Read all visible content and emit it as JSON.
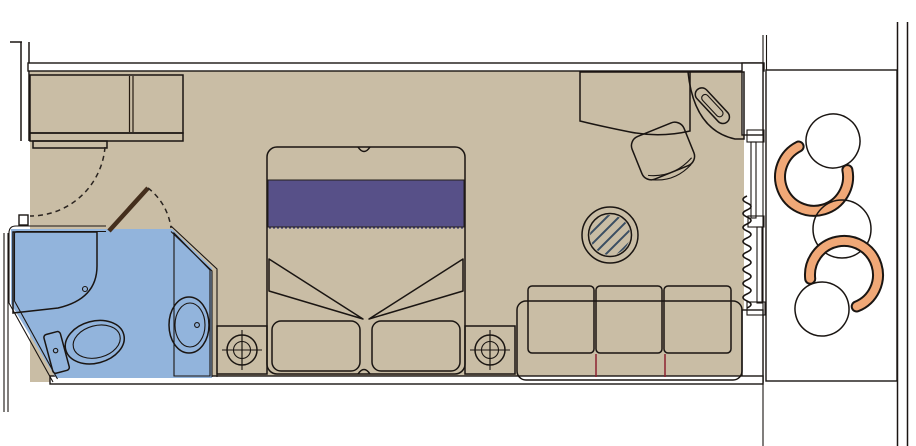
{
  "colors": {
    "background": "#ffffff",
    "outline": "#1a1512",
    "room_floor": "#c9bda5",
    "bathroom_floor": "#92b4dc",
    "balcony_deck": "#ac8a5e",
    "wood": "#8a6144",
    "wood_dark": "#442e1c",
    "fixture_white": "#ffffff",
    "bed_blanket": "#575088",
    "blanket_stitch": "#3f3a6e",
    "sofa_red": "#d84554",
    "sofa_line": "#8c2230",
    "chair_red": "#e24b5e",
    "glass_blue": "#cde3f2",
    "glass_hatch": "#3a4e63",
    "balcony_furniture": "#f0a877",
    "phone_body": "#d3dae0",
    "phone_inner": "#7d8894"
  },
  "plan": {
    "type": "cruise-cabin-floor-plan",
    "rooms": [
      {
        "name": "cabin",
        "furniture": [
          "wardrobe",
          "entry-door",
          "bathroom-door",
          "double-bed",
          "nightstand-left",
          "nightstand-right",
          "table-lamp-left",
          "table-lamp-right",
          "sofa",
          "glass-coffee-table",
          "desk",
          "desk-chair",
          "telephone",
          "curtain",
          "sliding-balcony-door"
        ]
      },
      {
        "name": "bathroom",
        "furniture": [
          "shower",
          "toilet",
          "washbasin",
          "vanity"
        ]
      },
      {
        "name": "balcony",
        "furniture": [
          "tub-chair-upper",
          "round-table",
          "tub-chair-lower"
        ]
      }
    ]
  }
}
